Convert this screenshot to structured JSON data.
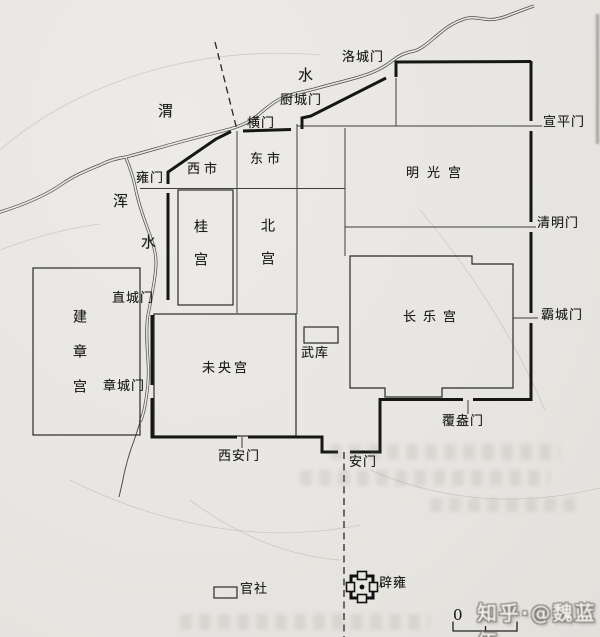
{
  "map": {
    "description_labels": "Han Chang'an city map labels",
    "colors": {
      "paper": "#e8e6e2",
      "wall_ink": "#161616",
      "street_ink": "#3d3d3d",
      "river_ink": "#4d4d4d",
      "label_ink": "#1b1b1b"
    },
    "labels": [
      {
        "id": "wei-river-char-wei",
        "text": "渭",
        "x": 158,
        "y": 104,
        "size": 15
      },
      {
        "id": "wei-river-char-shui",
        "text": "水",
        "x": 298,
        "y": 68,
        "size": 15
      },
      {
        "id": "hun-river-char-hun",
        "text": "浑",
        "x": 113,
        "y": 194,
        "size": 15
      },
      {
        "id": "hun-river-char-shui",
        "text": "水",
        "x": 141,
        "y": 235,
        "size": 15
      },
      {
        "id": "gate-luochengmen",
        "text": "洛城门",
        "x": 342,
        "y": 51
      },
      {
        "id": "gate-chuchengmen",
        "text": "厨城门",
        "x": 280,
        "y": 94
      },
      {
        "id": "gate-hengmen",
        "text": "横门",
        "x": 247,
        "y": 117
      },
      {
        "id": "gate-yongmen",
        "text": "雍门",
        "x": 136,
        "y": 172
      },
      {
        "id": "market-xishi",
        "text": "西市",
        "x": 187,
        "y": 163,
        "sp": 4
      },
      {
        "id": "market-dongshi",
        "text": "东市",
        "x": 250,
        "y": 153,
        "sp": 4
      },
      {
        "id": "gate-xuanpingmen",
        "text": "宣平门",
        "x": 543,
        "y": 116
      },
      {
        "id": "palace-mingguanggong",
        "text": "明光宫",
        "x": 406,
        "y": 167,
        "sp": 8
      },
      {
        "id": "gate-qingmingmen",
        "text": "清明门",
        "x": 537,
        "y": 217
      },
      {
        "id": "palace-guigong",
        "text": "桂宫",
        "x": 193,
        "y": 219,
        "v": true,
        "size": 14,
        "sp": 19
      },
      {
        "id": "palace-beigong",
        "text": "北宫",
        "x": 260,
        "y": 218,
        "v": true,
        "size": 14,
        "sp": 19
      },
      {
        "id": "gate-zhichengmen",
        "text": "直城门",
        "x": 112,
        "y": 292
      },
      {
        "id": "palace-jianzhanggong",
        "text": "建章宫",
        "x": 72,
        "y": 309,
        "v": true,
        "size": 14,
        "sp": 21
      },
      {
        "id": "gate-zhangchengmen",
        "text": "章城门",
        "x": 103,
        "y": 380
      },
      {
        "id": "palace-weiyanggong",
        "text": "未央宫",
        "x": 202,
        "y": 362,
        "sp": 3
      },
      {
        "id": "arsenal-wuku",
        "text": "武库",
        "x": 301,
        "y": 347
      },
      {
        "id": "palace-changlegong",
        "text": "长乐宫",
        "x": 403,
        "y": 311,
        "sp": 7
      },
      {
        "id": "gate-bachengmen",
        "text": "霸城门",
        "x": 541,
        "y": 309
      },
      {
        "id": "gate-fuangmen",
        "text": "覆盎门",
        "x": 442,
        "y": 415
      },
      {
        "id": "gate-xianmen",
        "text": "西安门",
        "x": 218,
        "y": 450
      },
      {
        "id": "gate-anmen",
        "text": "安门",
        "x": 349,
        "y": 456
      },
      {
        "id": "legend-guanshe",
        "text": "官社",
        "x": 240,
        "y": 583
      },
      {
        "id": "legend-biyong",
        "text": "辟雍",
        "x": 379,
        "y": 577
      },
      {
        "id": "scale-zero",
        "text": "0",
        "x": 453,
        "y": 608,
        "size": 15
      }
    ],
    "watermark": {
      "text": "知乎·@魏蓝伍"
    }
  }
}
